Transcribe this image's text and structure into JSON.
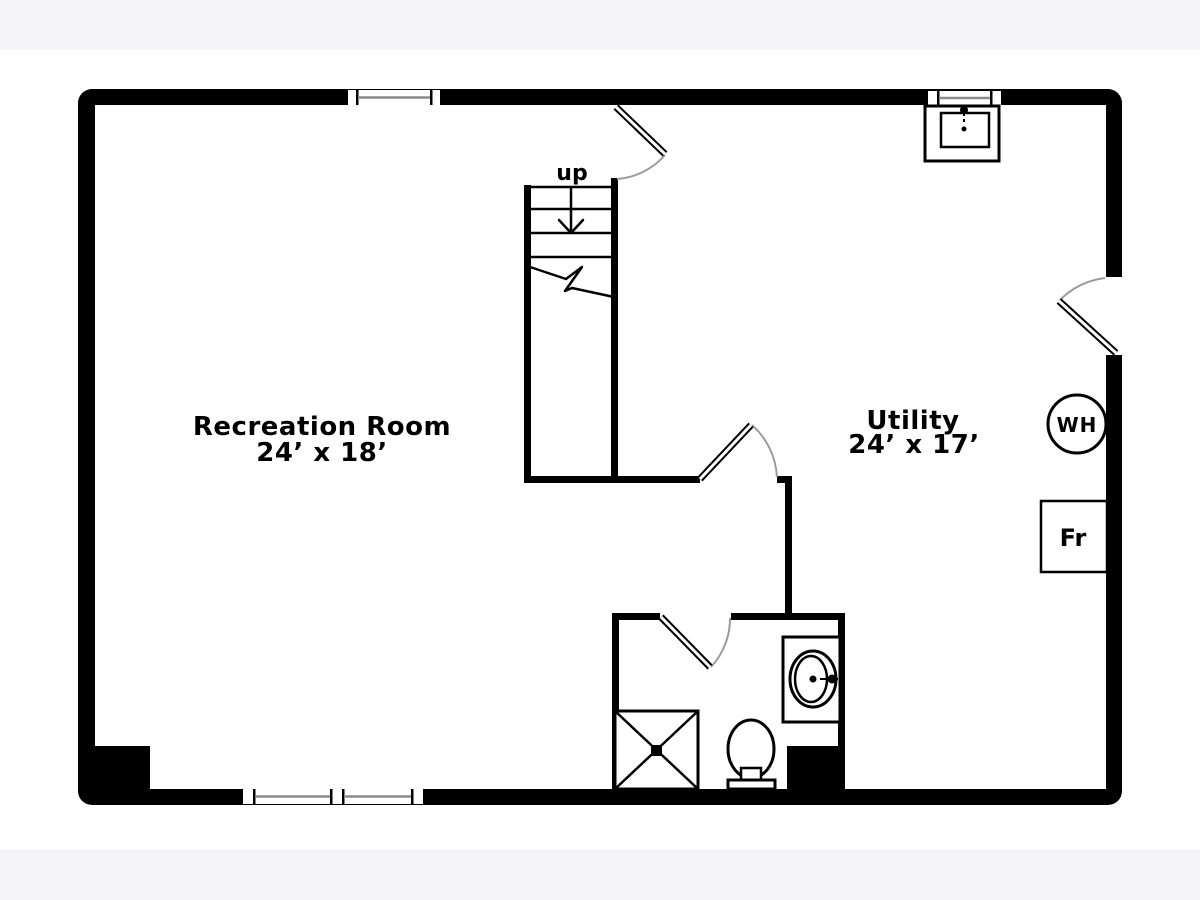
{
  "plan": {
    "type": "basement-floor-plan",
    "rooms": [
      {
        "name": "Recreation Room",
        "dimensions": "24’ x 18’"
      },
      {
        "name": "Utility",
        "dimensions": "24’ x 17’"
      }
    ],
    "stairs": {
      "direction_label": "up"
    },
    "appliances": {
      "water_heater_label": "WH",
      "freezer_label": "Fr"
    },
    "fixtures": [
      "laundry-tub",
      "shower",
      "toilet",
      "sink",
      "water-heater",
      "freezer"
    ]
  },
  "colors": {
    "background": "#f5f4f6",
    "paper": "#ffffff",
    "wall": "#000000",
    "door_arc": "#9b9b9b",
    "window_glass": "#8a8a8a"
  }
}
